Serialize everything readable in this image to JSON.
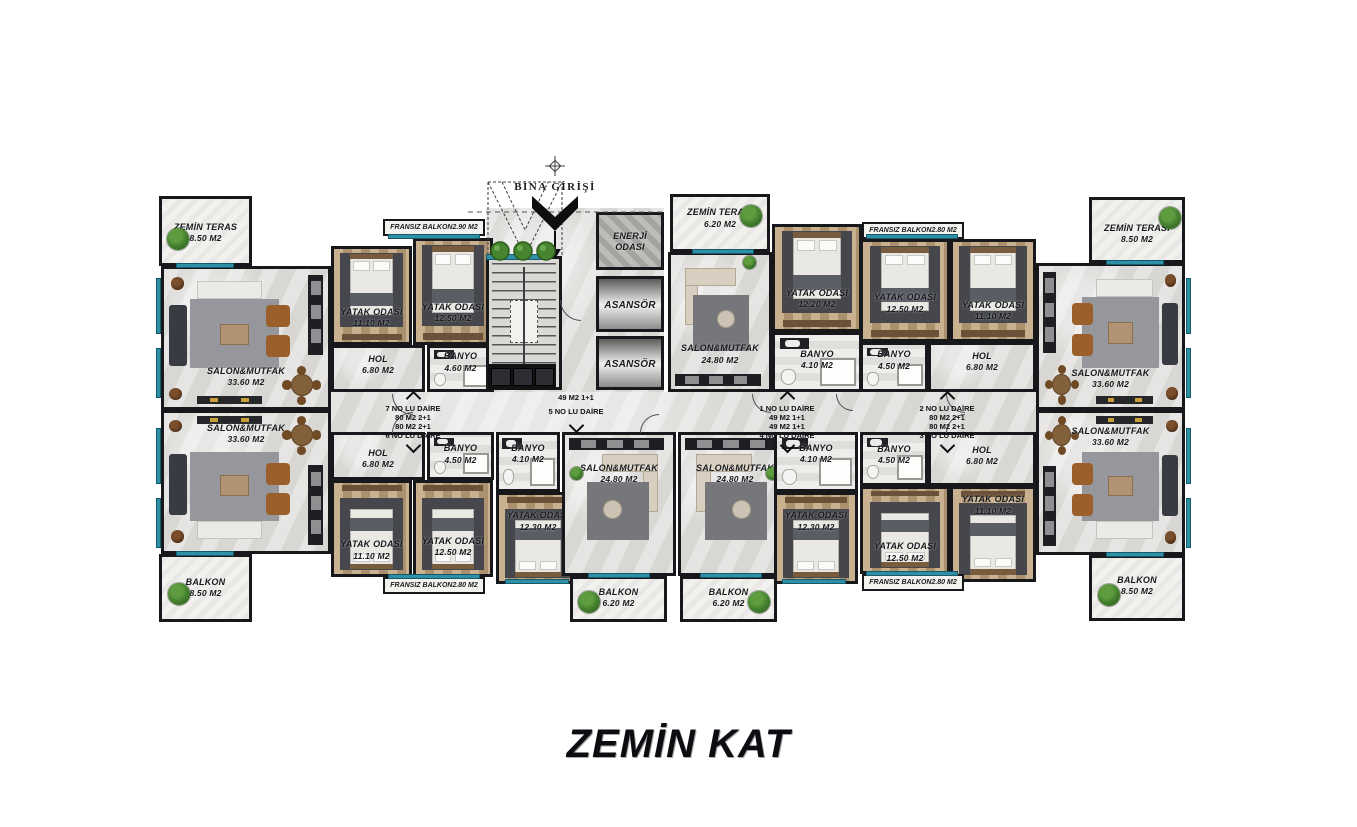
{
  "floor_title": "ZEMİN KAT",
  "entrance": {
    "label": "BİNA GİRİŞİ"
  },
  "colors": {
    "wall": "#16181c",
    "window_teal": "#2f8fa5",
    "floor": "#d9d7d4",
    "wood": "#bfa17a"
  },
  "corridor_labels": [
    {
      "x": 413,
      "up": [
        "7 NO LU DAİRE",
        "80 M2 2+1"
      ],
      "down": [
        "80 M2 2+1",
        "6 NO LU DAİRE"
      ]
    },
    {
      "x": 576,
      "up": [],
      "down": [
        "49 M2 1+1",
        "5 NO LU DAİRE"
      ]
    },
    {
      "x": 787,
      "up": [
        "1 NO LU DAİRE",
        "49 M2 1+1"
      ],
      "down": [
        "49 M2 1+1",
        "4 NO LU DAİRE"
      ]
    },
    {
      "x": 947,
      "up": [
        "2 NO LU DAİRE",
        "80 M2 2+1"
      ],
      "down": [
        "80 M2 2+1",
        "3 NO LU DAİRE"
      ]
    }
  ],
  "rooms": [
    {
      "id": "teras-sol",
      "name": "ZEMİN TERAS",
      "area": "8.50 M2",
      "type": "terrace",
      "x": 159,
      "y": 196,
      "w": 93,
      "h": 70,
      "labelPos": 0.36,
      "bush": [
        [
          0.17,
          0.6
        ]
      ]
    },
    {
      "id": "salon-7",
      "name": "SALON&MUTFAK",
      "area": "33.60 M2",
      "type": "living-large",
      "x": 161,
      "y": 266,
      "w": 170,
      "h": 144,
      "labelPos": 0.7,
      "mirror": false,
      "flip": false
    },
    {
      "id": "salon-6",
      "name": "SALON&MUTFAK",
      "area": "33.60 M2",
      "type": "living-large",
      "x": 161,
      "y": 410,
      "w": 170,
      "h": 144,
      "labelPos": 0.07,
      "mirror": false,
      "flip": true
    },
    {
      "id": "balkon-sol",
      "name": "BALKON",
      "area": "8.50 M2",
      "type": "terrace",
      "x": 159,
      "y": 554,
      "w": 93,
      "h": 68,
      "labelPos": 0.32,
      "bush": [
        [
          0.18,
          0.56
        ]
      ]
    },
    {
      "id": "fransiz-7",
      "name": "FRANSIZ BALKON2.90 M2",
      "type": "strip",
      "x": 383,
      "y": 219,
      "w": 102,
      "h": 17
    },
    {
      "id": "yatak-7a",
      "name": "YATAK ODASI",
      "area": "11.10 M2",
      "type": "bedroom",
      "x": 331,
      "y": 246,
      "w": 81,
      "h": 99,
      "labelPos": 0.62,
      "bed": "top"
    },
    {
      "id": "yatak-7b",
      "name": "YATAK ODASI",
      "area": "12.50 M2",
      "type": "bedroom",
      "x": 413,
      "y": 238,
      "w": 80,
      "h": 107,
      "labelPos": 0.6,
      "bed": "top"
    },
    {
      "id": "hol-7",
      "name": "HOL",
      "area": "6.80 M2",
      "type": "hol",
      "x": 331,
      "y": 345,
      "w": 94,
      "h": 47,
      "labelPos": 0.14
    },
    {
      "id": "banyo-7",
      "name": "BANYO",
      "area": "4.60 M2",
      "type": "bath",
      "x": 427,
      "y": 345,
      "w": 67,
      "h": 47,
      "labelPos": 0.08
    },
    {
      "id": "hol-6",
      "name": "HOL",
      "area": "6.80 M2",
      "type": "hol",
      "x": 331,
      "y": 432,
      "w": 94,
      "h": 48,
      "labelPos": 0.3
    },
    {
      "id": "banyo-6",
      "name": "BANYO",
      "area": "4.50 M2",
      "type": "bath",
      "x": 427,
      "y": 432,
      "w": 67,
      "h": 48,
      "labelPos": 0.2
    },
    {
      "id": "yatak-6a",
      "name": "YATAK ODASI",
      "area": "11.10 M2",
      "type": "bedroom",
      "x": 331,
      "y": 480,
      "w": 81,
      "h": 97,
      "labelPos": 0.62,
      "bed": "bottom"
    },
    {
      "id": "yatak-6b",
      "name": "YATAK ODASI",
      "area": "12.50 M2",
      "type": "bedroom",
      "x": 413,
      "y": 480,
      "w": 80,
      "h": 97,
      "labelPos": 0.58,
      "bed": "bottom"
    },
    {
      "id": "fransiz-6",
      "name": "FRANSIZ BALKON2.80 M2",
      "type": "strip",
      "x": 383,
      "y": 577,
      "w": 102,
      "h": 17
    },
    {
      "id": "merdiven",
      "name": "",
      "type": "stairs",
      "x": 486,
      "y": 256,
      "w": 76,
      "h": 134
    },
    {
      "id": "enerji",
      "name": "ENERJİ ODASI",
      "type": "utility",
      "x": 596,
      "y": 212,
      "w": 68,
      "h": 58
    },
    {
      "id": "asansor-1",
      "name": "ASANSÖR",
      "type": "elevator",
      "x": 596,
      "y": 276,
      "w": 68,
      "h": 56
    },
    {
      "id": "asansor-2",
      "name": "ASANSÖR",
      "type": "elevator",
      "x": 596,
      "y": 336,
      "w": 68,
      "h": 54
    },
    {
      "id": "teras-1",
      "name": "ZEMİN TERASI",
      "area": "6.20 M2",
      "type": "terrace",
      "x": 670,
      "y": 194,
      "w": 100,
      "h": 58,
      "labelPos": 0.2,
      "bush": [
        [
          0.82,
          0.3
        ]
      ]
    },
    {
      "id": "salon-1",
      "name": "SALON&MUTFAK",
      "area": "24.80 M2",
      "type": "living-small",
      "x": 668,
      "y": 252,
      "w": 104,
      "h": 140,
      "labelPos": 0.66,
      "kitchen": "bottom",
      "mirror": false,
      "bushAt": [
        0.78,
        0.06
      ]
    },
    {
      "id": "yatak-1",
      "name": "YATAK ODASI",
      "area": "12.20 M2",
      "type": "bedroom",
      "x": 772,
      "y": 224,
      "w": 90,
      "h": 108,
      "labelPos": 0.6,
      "bed": "top"
    },
    {
      "id": "banyo-1",
      "name": "BANYO",
      "area": "4.10 M2",
      "type": "bath",
      "x": 772,
      "y": 332,
      "w": 90,
      "h": 60,
      "labelPos": 0.26
    },
    {
      "id": "fransiz-2",
      "name": "FRANSIZ BALKON2.80 M2",
      "type": "strip",
      "x": 862,
      "y": 222,
      "w": 102,
      "h": 17
    },
    {
      "id": "yatak-2a",
      "name": "YATAK ODASI",
      "area": "12.50 M2",
      "type": "bedroom",
      "x": 860,
      "y": 239,
      "w": 90,
      "h": 103,
      "labelPos": 0.52,
      "bed": "top"
    },
    {
      "id": "yatak-2b",
      "name": "YATAK ODASI",
      "area": "11.10 M2",
      "type": "bedroom",
      "x": 950,
      "y": 239,
      "w": 86,
      "h": 103,
      "labelPos": 0.6,
      "bed": "top"
    },
    {
      "id": "banyo-2",
      "name": "BANYO",
      "area": "4.50 M2",
      "type": "bath",
      "x": 860,
      "y": 342,
      "w": 68,
      "h": 50,
      "labelPos": 0.1
    },
    {
      "id": "hol-2",
      "name": "HOL",
      "area": "6.80 M2",
      "type": "hol",
      "x": 928,
      "y": 342,
      "w": 108,
      "h": 50,
      "labelPos": 0.14
    },
    {
      "id": "teras-2",
      "name": "ZEMİN TERASI",
      "area": "8.50 M2",
      "type": "terrace",
      "x": 1089,
      "y": 197,
      "w": 96,
      "h": 66,
      "labelPos": 0.38,
      "bush": [
        [
          0.85,
          0.26
        ]
      ]
    },
    {
      "id": "salon-2",
      "name": "SALON&MUTFAK",
      "area": "33.60 M2",
      "type": "living-large",
      "x": 1036,
      "y": 263,
      "w": 149,
      "h": 147,
      "labelPos": 0.72,
      "mirror": true,
      "flip": false
    },
    {
      "id": "salon-3",
      "name": "SALON&MUTFAK",
      "area": "33.60 M2",
      "type": "living-large",
      "x": 1036,
      "y": 410,
      "w": 149,
      "h": 145,
      "labelPos": 0.09,
      "mirror": true,
      "flip": true
    },
    {
      "id": "balkon-sag",
      "name": "BALKON",
      "area": "8.50 M2",
      "type": "terrace",
      "x": 1089,
      "y": 555,
      "w": 96,
      "h": 66,
      "labelPos": 0.28,
      "bush": [
        [
          0.18,
          0.58
        ]
      ]
    },
    {
      "id": "banyo-3",
      "name": "BANYO",
      "area": "4.50 M2",
      "type": "bath",
      "x": 860,
      "y": 432,
      "w": 68,
      "h": 54,
      "labelPos": 0.18
    },
    {
      "id": "hol-3",
      "name": "HOL",
      "area": "6.80 M2",
      "type": "hol",
      "x": 928,
      "y": 432,
      "w": 108,
      "h": 54,
      "labelPos": 0.2
    },
    {
      "id": "yatak-3a",
      "name": "YATAK ODASI",
      "area": "11.10 M2",
      "type": "bedroom",
      "x": 950,
      "y": 486,
      "w": 86,
      "h": 96,
      "labelPos": 0.06,
      "bed": "bottom"
    },
    {
      "id": "yatak-3b",
      "name": "YATAK ODASI",
      "area": "12.50 M2",
      "type": "bedroom",
      "x": 860,
      "y": 486,
      "w": 90,
      "h": 88,
      "labelPos": 0.64,
      "bed": "bottom"
    },
    {
      "id": "fransiz-3",
      "name": "FRANSIZ BALKON2.80 M2",
      "type": "strip",
      "x": 862,
      "y": 574,
      "w": 102,
      "h": 17
    },
    {
      "id": "banyo-5",
      "name": "BANYO",
      "area": "4.10 M2",
      "type": "bath",
      "x": 496,
      "y": 432,
      "w": 64,
      "h": 60,
      "labelPos": 0.14
    },
    {
      "id": "yatak-5",
      "name": "YATAK ODASI",
      "area": "12.30 M2",
      "type": "bedroom",
      "x": 496,
      "y": 492,
      "w": 84,
      "h": 92,
      "labelPos": 0.18,
      "bed": "bottom"
    },
    {
      "id": "salon-5",
      "name": "SALON&MUTFAK",
      "area": "24.80 M2",
      "type": "living-small",
      "x": 562,
      "y": 432,
      "w": 114,
      "h": 144,
      "labelPos": 0.2,
      "kitchen": "top",
      "mirror": true,
      "bushAt": [
        0.1,
        0.28
      ]
    },
    {
      "id": "balkon-5",
      "name": "BALKON",
      "area": "6.20 M2",
      "type": "terrace",
      "x": 570,
      "y": 576,
      "w": 97,
      "h": 46,
      "labelPos": 0.2,
      "bush": [
        [
          0.16,
          0.44
        ]
      ]
    },
    {
      "id": "salon-4",
      "name": "SALON&MUTFAK",
      "area": "24.80 M2",
      "type": "living-small",
      "x": 678,
      "y": 432,
      "w": 114,
      "h": 144,
      "labelPos": 0.2,
      "kitchen": "top",
      "mirror": false,
      "bushAt": [
        0.84,
        0.28
      ]
    },
    {
      "id": "banyo-4",
      "name": "BANYO",
      "area": "4.10 M2",
      "type": "bath",
      "x": 774,
      "y": 432,
      "w": 84,
      "h": 60,
      "labelPos": 0.14
    },
    {
      "id": "yatak-4",
      "name": "YATAK ODASI",
      "area": "12.30 M2",
      "type": "bedroom",
      "x": 774,
      "y": 492,
      "w": 84,
      "h": 92,
      "labelPos": 0.18,
      "bed": "bottom"
    },
    {
      "id": "balkon-4",
      "name": "BALKON",
      "area": "6.20 M2",
      "type": "terrace",
      "x": 680,
      "y": 576,
      "w": 97,
      "h": 46,
      "labelPos": 0.2,
      "bush": [
        [
          0.82,
          0.44
        ]
      ]
    }
  ]
}
